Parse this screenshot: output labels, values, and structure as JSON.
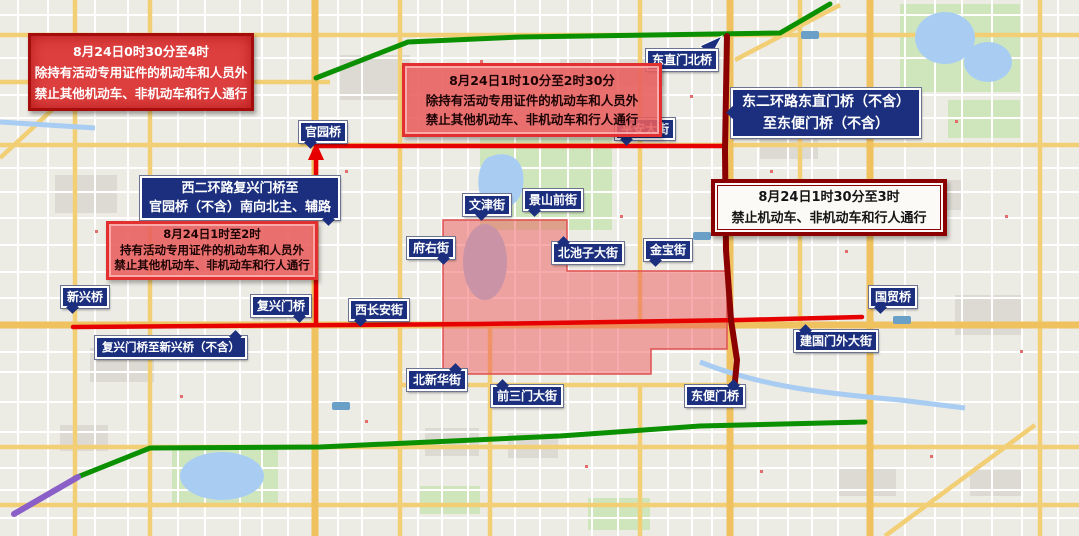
{
  "title": "北京交通管制示意图",
  "boxes": {
    "top_left": {
      "lines": [
        "8月24日0时30分至4时",
        "除持有活动专用证件的机动车和人员外",
        "禁止其他机动车、非机动车和行人通行"
      ]
    },
    "top_center": {
      "lines": [
        "8月24日1时10分至2时30分",
        "除持有活动专用证件的机动车和人员外",
        "禁止其他机动车、非机动车和行人通行"
      ]
    },
    "west": {
      "lines": [
        "8月24日1时至2时",
        "持有活动专用证件的机动车和人员外",
        "禁止其他机动车、非机动车和行人通行"
      ]
    },
    "east": {
      "lines": [
        "8月24日1时30分至3时",
        "禁止机动车、非机动车和行人通行"
      ]
    }
  },
  "labels": {
    "dongzhimen_north_bridge": "东直门北桥",
    "east_2nd_ring_line1": "东二环路东直门桥（不含）",
    "east_2nd_ring_line2": "至东便门桥（不含）",
    "pingan_street": "平安大街",
    "guanyuan_bridge": "官园桥",
    "west_2nd_ring_line1": "西二环路复兴门桥至",
    "west_2nd_ring_line2": "官园桥（不含）南向北主、辅路",
    "wenjin_street": "文津街",
    "jingshan_front_street": "景山前街",
    "fuyou_street": "府右街",
    "beichizi_street": "北池子大街",
    "jinbao_street": "金宝街",
    "xinxing_bridge": "新兴桥",
    "fuxingmen_bridge": "复兴门桥",
    "west_changan_street": "西长安街",
    "fuxingmen_to_xinxing": "复兴门桥至新兴桥（不含）",
    "beixinhua_street": "北新华街",
    "qiansanmen_street": "前三门大街",
    "dongbianmen_bridge": "东便门桥",
    "jianguomenwai_street": "建国门外大街",
    "guomao_bridge": "国贸桥"
  },
  "colors": {
    "restricted_route_red": "#e60000",
    "east_second_ring_dark_red": "#8b0000",
    "route_green": "#0a9000",
    "route_purple": "#8a5fc8",
    "restricted_zone_fill": "rgba(238,90,90,0.5)",
    "badge_navy": "#1b2f7e"
  }
}
